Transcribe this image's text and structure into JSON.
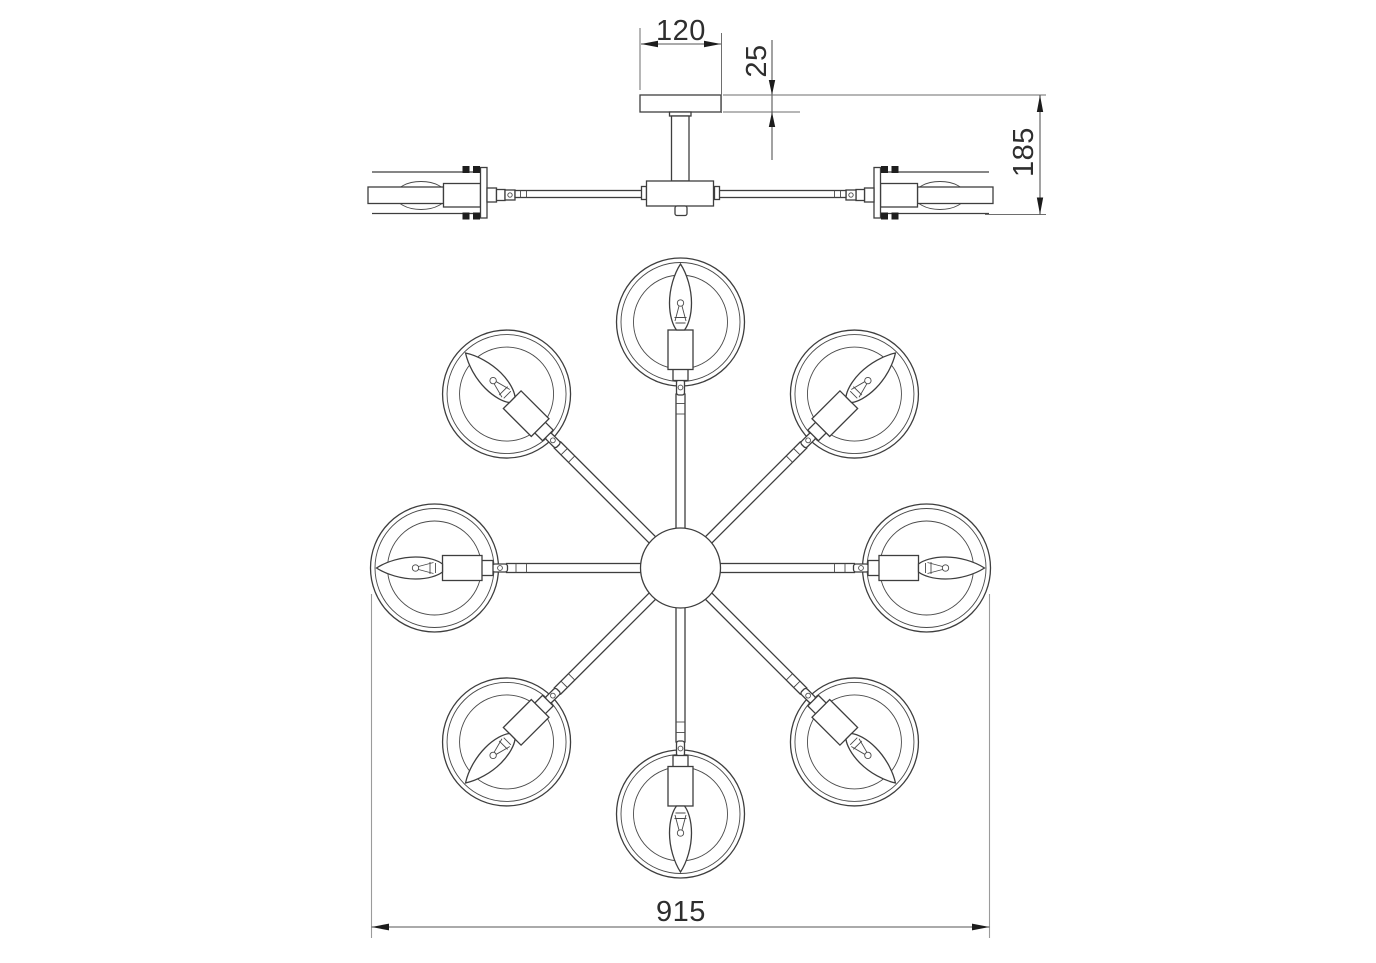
{
  "title": "Chandelier dimensional drawing",
  "drawing": {
    "views": {
      "side_view": "front elevation with ceiling canopy",
      "top_view": "plan view with radial arms"
    },
    "lamp_count": 8,
    "arm_angles_deg": [
      0,
      45,
      90,
      135,
      180,
      225,
      270,
      315
    ]
  },
  "dimensions": {
    "canopy_width": "120",
    "canopy_height": "25",
    "fixture_height": "185",
    "fixture_diameter": "915"
  },
  "colors": {
    "background": "#ffffff",
    "line": "#3e3e3e",
    "dimension_line": "#565656",
    "text": "#2e2e2e"
  }
}
